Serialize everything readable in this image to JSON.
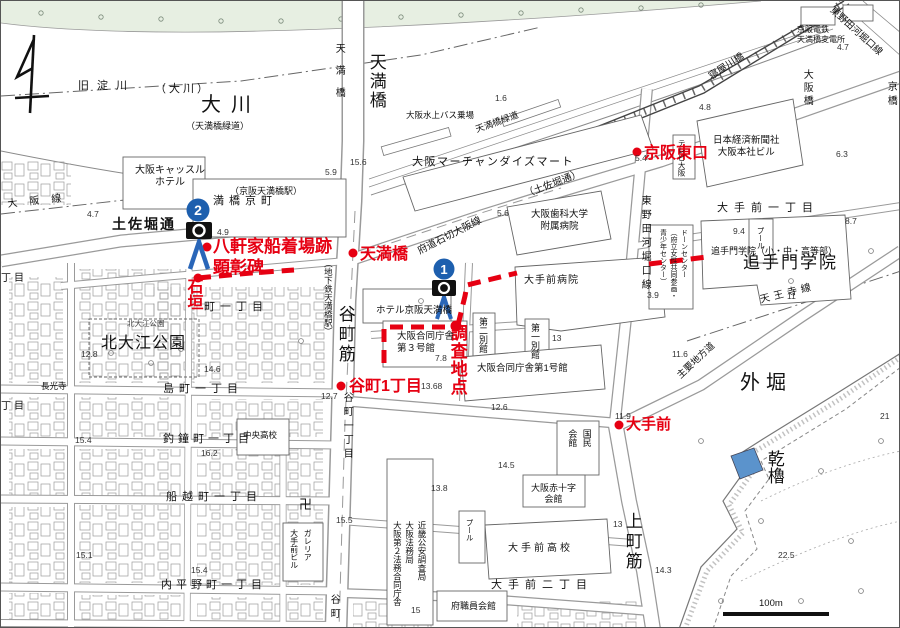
{
  "colors": {
    "route_red": "#e60012",
    "marker_blue": "#1d5fae",
    "turret_blue": "#5b93cc",
    "park_green": "#e7efe2",
    "map_line_gray": "#8a8a8a"
  },
  "icons": {
    "north_arrow": "magnetic-north-arrow",
    "camera": "camera-icon",
    "view_direction": "view-direction-arrow",
    "temple": "manji-icon"
  },
  "water": {
    "okawa": "大川",
    "kyu_yodogawa": "旧淀川",
    "okawa_paren": "（大川）",
    "neyagawa_bashi": "寝屋川橋"
  },
  "bridges": {
    "tenmabashi_large": "天満橋",
    "tenmabashi_small": "天満橋",
    "osakabashi": "大阪橋",
    "kyobashi": "京橋"
  },
  "roads": {
    "tosabori": "土佐堀通",
    "tosabori_paren": "（土佐堀通）",
    "ishikiri": "府道石切大阪線",
    "ryokudo_paren": "（天満橋緑道）",
    "ryokudo": "天満橋緑道",
    "tanimachi_suji": "谷町筋",
    "uemachi_suji": "上町筋",
    "higashinoda_v": "東野田河堀口線",
    "higashinoda_d": "東野田河堀口線",
    "shuyo_chihodo": "主要地方道",
    "tennoji_sen": "天王寺線",
    "osaka_sen": "大阪線"
  },
  "stations": {
    "keihan_tenmabashi": "（京阪天満橋駅）",
    "chikatetsu_tenmabashi": "（地下鉄天満橋駅）"
  },
  "red_markers": {
    "tenmabashi": "天満橋",
    "keihan_east": "京阪東口",
    "hachikenya": "八軒家船着場跡\n顕彰碑",
    "ishigaki": "石垣",
    "chosa_chiten": "調査地点",
    "tanimachi_1chome": "谷町1丁目",
    "otemae": "大手前"
  },
  "cameras": {
    "no1": "1",
    "no2": "2"
  },
  "districts": {
    "kyomachi": "満橋京町",
    "ishimachi": "町一丁目",
    "shimamachi": "島町一丁目",
    "tsurigane": "釣鐘町一丁目",
    "funakoshi": "船越町一丁目",
    "uchihirano": "内平野町一丁目",
    "otemae1": "大手前一丁目",
    "otemae2": "大手前二丁目",
    "tanimachi_st_n": "谷町一丁目",
    "tanimachi_st_s": "谷町",
    "partial_chome_a": "丁目",
    "partial_chome_b": "丁目"
  },
  "parks": {
    "kitaoe_big": "北大江公園",
    "kitaoe_small": "北大江公園"
  },
  "buildings": {
    "castle_hotel": "大阪キャッスル\nホテル",
    "omm": "大阪マーチャンダイズマート",
    "suijo_bus": "大阪水上バス乗場",
    "nikkei": "日本経済新聞社\n大阪本社ビル",
    "tv_osaka": "テレビ大阪",
    "hensho": "京阪電鉄\n天満橋変電所",
    "shika_univ": "大阪歯科大学\n附属病院",
    "otemae_hosp": "大手前病院",
    "hotel_keihan": "ホテル京阪天満橋",
    "godo3": "大阪合同庁舎\n第３号館",
    "bekkan2": "第二別館",
    "bekkan1": "第一別館",
    "godo1": "大阪合同庁舎第1号館",
    "dawn_center": "ドーンセンター\n（府立女性共同参画・\n青少年センター）",
    "otemon": "追手門学院",
    "otemon_small": "追手門学院（小・中・高等部）",
    "pool_otemon": "プール",
    "kokumin": "国民\n会館",
    "sekijuji": "大阪赤十字\n会館",
    "otemae_hs": "大手前高校",
    "pool_hs": "プール",
    "fushokuin": "府職員会館",
    "koan": "近畿公安調査局\n大阪法務局\n大阪第２法務合同庁舎",
    "galleria": "ガレリア\n大手前ビル",
    "chuo_hs": "中央高校",
    "chokoji": "長光寺",
    "manji": "卍"
  },
  "castle": {
    "sotobori": "外堀",
    "inui_yagura": "乾櫓"
  },
  "scale_bar": {
    "label": "100m"
  },
  "spot_elevations": [
    {
      "v": "15.6",
      "x": 349,
      "y": 156
    },
    {
      "v": "5.9",
      "x": 324,
      "y": 166
    },
    {
      "v": "1.6",
      "x": 494,
      "y": 92
    },
    {
      "v": "4.8",
      "x": 698,
      "y": 101
    },
    {
      "v": "6.3",
      "x": 835,
      "y": 148
    },
    {
      "v": "4.7",
      "x": 836,
      "y": 41
    },
    {
      "v": "4.7",
      "x": 86,
      "y": 208
    },
    {
      "v": "4.9",
      "x": 216,
      "y": 226
    },
    {
      "v": "5.6",
      "x": 496,
      "y": 207
    },
    {
      "v": "5.4",
      "x": 634,
      "y": 152
    },
    {
      "v": "3.9",
      "x": 646,
      "y": 289
    },
    {
      "v": "9.4",
      "x": 732,
      "y": 225
    },
    {
      "v": "8.7",
      "x": 844,
      "y": 215
    },
    {
      "v": "11",
      "x": 786,
      "y": 290
    },
    {
      "v": "11.6",
      "x": 671,
      "y": 348
    },
    {
      "v": "11.9",
      "x": 614,
      "y": 410
    },
    {
      "v": "12.7",
      "x": 320,
      "y": 390
    },
    {
      "v": "12.8",
      "x": 80,
      "y": 348
    },
    {
      "v": "14.6",
      "x": 203,
      "y": 363
    },
    {
      "v": "16.2",
      "x": 200,
      "y": 447
    },
    {
      "v": "15.4",
      "x": 74,
      "y": 434
    },
    {
      "v": "15.4",
      "x": 190,
      "y": 564
    },
    {
      "v": "15.1",
      "x": 75,
      "y": 549
    },
    {
      "v": "13.68",
      "x": 420,
      "y": 380
    },
    {
      "v": "12.6",
      "x": 490,
      "y": 401
    },
    {
      "v": "14.5",
      "x": 497,
      "y": 459
    },
    {
      "v": "13.8",
      "x": 430,
      "y": 482
    },
    {
      "v": "15.5",
      "x": 335,
      "y": 514
    },
    {
      "v": "15",
      "x": 410,
      "y": 604
    },
    {
      "v": "13",
      "x": 612,
      "y": 518
    },
    {
      "v": "13",
      "x": 551,
      "y": 332
    },
    {
      "v": "14.3",
      "x": 654,
      "y": 564
    },
    {
      "v": "22.5",
      "x": 777,
      "y": 549
    },
    {
      "v": "21",
      "x": 879,
      "y": 410
    },
    {
      "v": "7.8",
      "x": 434,
      "y": 352
    }
  ]
}
